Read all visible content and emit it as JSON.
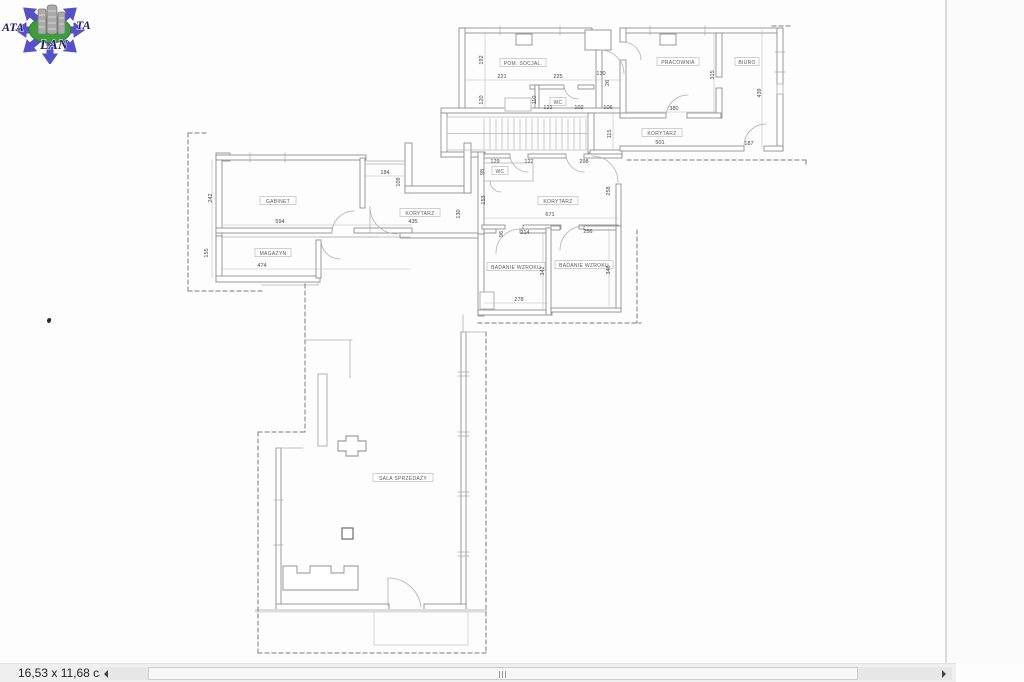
{
  "logo": {
    "text_left": "ATA",
    "text_right": "TA",
    "text_bottom": "LAN"
  },
  "status_bar": {
    "page_size": "16,53 x 11,68 cale"
  },
  "scrollbar": {
    "left_arrow": "left-triangle",
    "right_arrow": "right-triangle"
  },
  "colors": {
    "wall": "#909090",
    "thin_line": "#b5b5b5",
    "dashed": "#7d7d7d",
    "label_text": "#5a5a5a",
    "dim_text": "#4a4a4a",
    "logo_blue": "#5551c8",
    "logo_green": "#3e9b3e",
    "logo_text": "#22226a",
    "section_band": "#dcdcdc"
  },
  "floorplan": {
    "room_labels": [
      {
        "text": "POM. SOCJAL.",
        "x": 523,
        "y": 64,
        "w": 46
      },
      {
        "text": "WC",
        "x": 558,
        "y": 103,
        "w": 16
      },
      {
        "text": "PRACOWNIA",
        "x": 678,
        "y": 63,
        "w": 42
      },
      {
        "text": "BIURO",
        "x": 747,
        "y": 63,
        "w": 24
      },
      {
        "text": "KORYTARZ",
        "x": 662,
        "y": 134,
        "w": 40
      },
      {
        "text": "GABINET",
        "x": 278,
        "y": 202,
        "w": 36
      },
      {
        "text": "MAGAZYN",
        "x": 273,
        "y": 254,
        "w": 36
      },
      {
        "text": "KORYTARZ",
        "x": 420,
        "y": 214,
        "w": 40
      },
      {
        "text": "WC",
        "x": 500,
        "y": 172,
        "w": 16
      },
      {
        "text": "KORYTARZ",
        "x": 558,
        "y": 202,
        "w": 40
      },
      {
        "text": "BADANIE WZROKU",
        "x": 516,
        "y": 268,
        "w": 58
      },
      {
        "text": "BADANIE WZROKU",
        "x": 584,
        "y": 266,
        "w": 58
      },
      {
        "text": "SALA SPRZEDAŻY",
        "x": 403,
        "y": 479,
        "w": 60
      }
    ],
    "dimensions": [
      {
        "value": "221",
        "x": 502,
        "y": 78
      },
      {
        "value": "225",
        "x": 558,
        "y": 78
      },
      {
        "value": "130",
        "x": 601,
        "y": 75
      },
      {
        "value": "26",
        "x": 609,
        "y": 83,
        "vertical": true
      },
      {
        "value": "192",
        "x": 483,
        "y": 60,
        "vertical": true
      },
      {
        "value": "120",
        "x": 483,
        "y": 100,
        "vertical": true
      },
      {
        "value": "110",
        "x": 536,
        "y": 100,
        "vertical": true
      },
      {
        "value": "121",
        "x": 548,
        "y": 109
      },
      {
        "value": "102",
        "x": 579,
        "y": 109
      },
      {
        "value": "106",
        "x": 608,
        "y": 109
      },
      {
        "value": "115",
        "x": 611,
        "y": 134,
        "vertical": true
      },
      {
        "value": "315",
        "x": 714,
        "y": 75,
        "vertical": true
      },
      {
        "value": "380",
        "x": 674,
        "y": 110
      },
      {
        "value": "439",
        "x": 761,
        "y": 93,
        "vertical": true
      },
      {
        "value": "501",
        "x": 660,
        "y": 144
      },
      {
        "value": "187",
        "x": 749,
        "y": 145
      },
      {
        "value": "242",
        "x": 212,
        "y": 198,
        "vertical": true
      },
      {
        "value": "594",
        "x": 280,
        "y": 223
      },
      {
        "value": "155",
        "x": 208,
        "y": 253,
        "vertical": true
      },
      {
        "value": "474",
        "x": 262,
        "y": 267
      },
      {
        "value": "184",
        "x": 385,
        "y": 174
      },
      {
        "value": "109",
        "x": 400,
        "y": 182,
        "vertical": true
      },
      {
        "value": "435",
        "x": 413,
        "y": 223
      },
      {
        "value": "130",
        "x": 460,
        "y": 214,
        "vertical": true
      },
      {
        "value": "153",
        "x": 485,
        "y": 200,
        "vertical": true
      },
      {
        "value": "98",
        "x": 484,
        "y": 172,
        "vertical": true
      },
      {
        "value": "129",
        "x": 495,
        "y": 163
      },
      {
        "value": "122",
        "x": 529,
        "y": 163
      },
      {
        "value": "298",
        "x": 584,
        "y": 163
      },
      {
        "value": "671",
        "x": 550,
        "y": 216
      },
      {
        "value": "258",
        "x": 610,
        "y": 191,
        "vertical": true
      },
      {
        "value": "96",
        "x": 503,
        "y": 234,
        "vertical": true
      },
      {
        "value": "214",
        "x": 525,
        "y": 234
      },
      {
        "value": "256",
        "x": 588,
        "y": 233
      },
      {
        "value": "278",
        "x": 519,
        "y": 301
      },
      {
        "value": "342",
        "x": 544,
        "y": 271,
        "vertical": true
      },
      {
        "value": "346",
        "x": 610,
        "y": 270,
        "vertical": true
      }
    ]
  }
}
